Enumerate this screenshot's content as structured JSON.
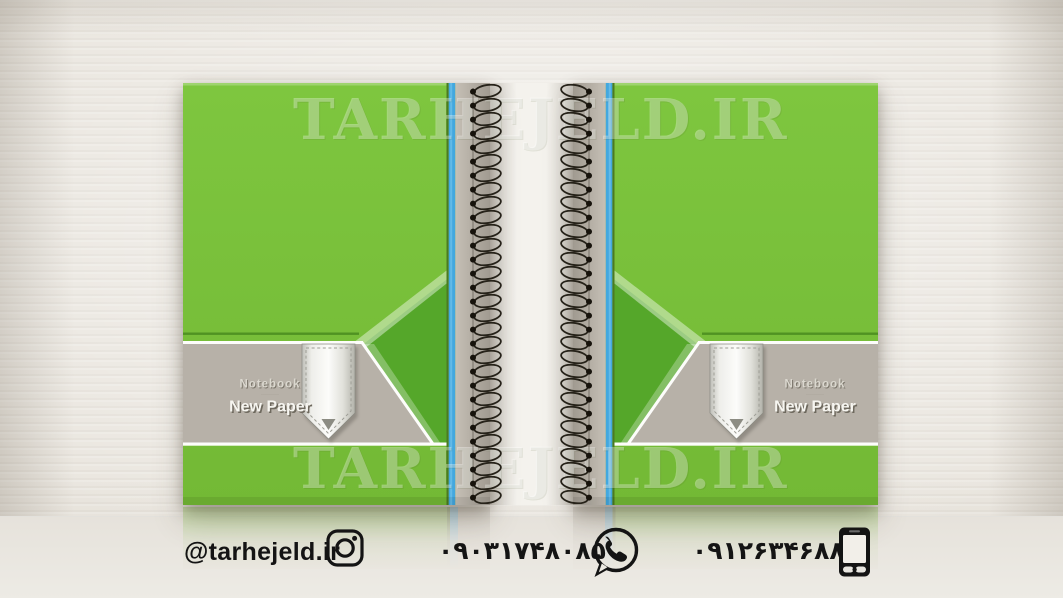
{
  "watermark": {
    "text": "TARHEJELD.IR"
  },
  "back_cover": {
    "brand": "Notebook",
    "tagline": "·········",
    "product": "New Paper"
  },
  "front_cover": {
    "brand": "Notebook",
    "tagline": "·········",
    "product": "New Paper"
  },
  "contact": {
    "instagram_handle": "@tarhejeld.ir",
    "phone_number_1": "۰۹۰۳۱۷۴۸۰۸۵",
    "phone_number_2": "۰۹۱۲۶۳۴۶۸۸۵"
  },
  "colors": {
    "cover_green": "#7cc13c",
    "chevron_dark_green": "#55a72a",
    "spine_blue": "#43a8df",
    "band_gray": "#b7b1a8",
    "spine_gray": "#b3ada3",
    "wall_background": "#eae6df",
    "contact_text": "#141414"
  }
}
